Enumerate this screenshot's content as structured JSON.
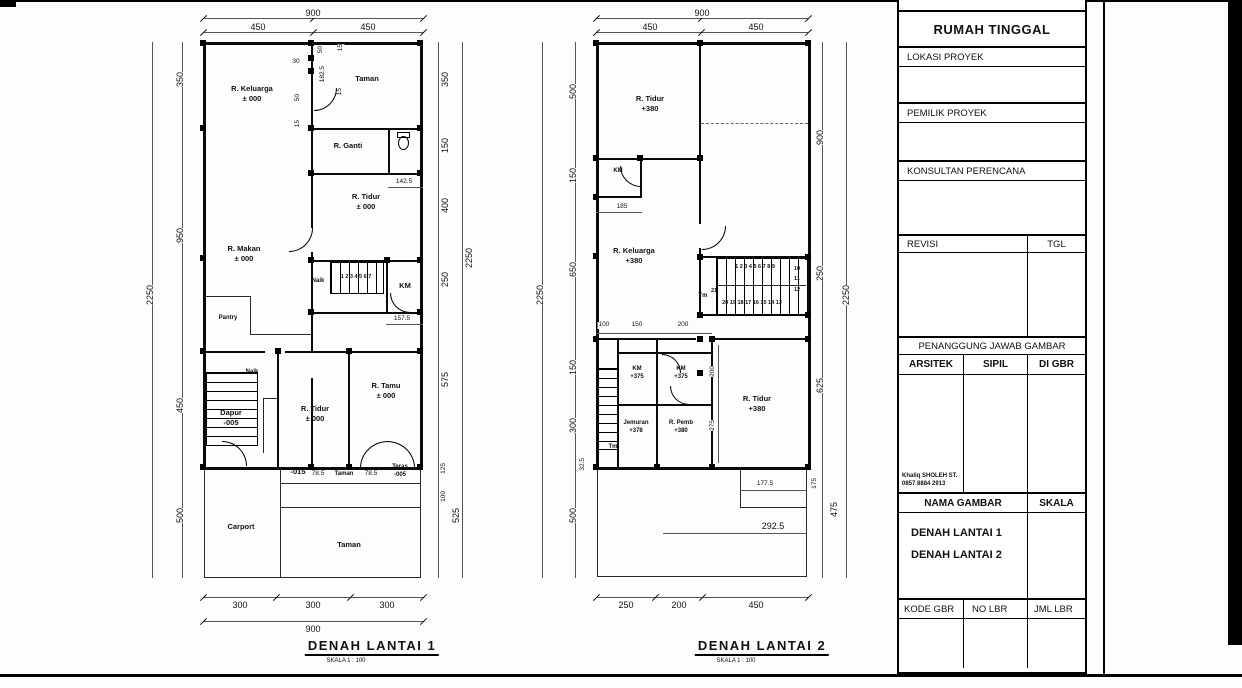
{
  "sheet": {
    "background": "#fdfdfd",
    "line_color": "#000000"
  },
  "title_block": {
    "nama_proyek_label": "NAMA PROYEK",
    "project_name": "RUMAH TINGGAL",
    "lokasi_label": "LOKASI PROYEK",
    "pemilik_label": "PEMILIK PROYEK",
    "konsultan_label": "KONSULTAN PERENCANA",
    "revisi_label": "REVISI",
    "tgl_label": "TGL",
    "penanggung_label": "PENANGGUNG JAWAB GAMBAR",
    "arsitek_label": "ARSITEK",
    "sipil_label": "SIPIL",
    "di_gbr_label": "DI GBR",
    "arsitek_name": "Khaliq SHOLEH ST.",
    "arsitek_phone": "0857 8884 2913",
    "nama_gambar_label": "NAMA GAMBAR",
    "skala_label": "SKALA",
    "drawing1": "DENAH LANTAI 1",
    "drawing2": "DENAH LANTAI 2",
    "kode_gbr_label": "KODE GBR",
    "no_lbr_label": "NO LBR",
    "jml_lbr_label": "JML LBR"
  },
  "plan1": {
    "title": "DENAH  LANTAI 1",
    "subtitle": "SKALA 1 : 100",
    "rooms": {
      "keluarga": "R. Keluarga\n± 000",
      "taman_atas": "Taman",
      "ganti": "R. Ganti",
      "tidur1": "R. Tidur\n± 000",
      "makan": "R. Makan\n± 000",
      "naik1": "Naik",
      "km1": "KM",
      "pantry": "Pantry",
      "naik2": "Naik",
      "dapur": "Dapur\n-005",
      "tidur2": "R. Tidur\n± 000",
      "tamu": "R. Tamu\n± 000",
      "taman_strip": "Taman",
      "teras": "Teras\n-005",
      "carport": "Carport",
      "taman_bawah": "Taman",
      "lvl015": "-015"
    },
    "stairs": {
      "numbers": "1 2 3 4 5 6 7"
    },
    "dims": {
      "top900": "900",
      "top450a": "450",
      "top450b": "450",
      "l2250": "2250",
      "l350": "350",
      "l950": "950",
      "l450": "450",
      "l500": "500",
      "r350": "350",
      "r150": "150",
      "r400": "400",
      "r250": "250",
      "r575": "575",
      "r125": "125",
      "r100": "100",
      "r525": "525",
      "r2250": "2250",
      "b300a": "300",
      "b300b": "300",
      "b300c": "300",
      "b900": "900",
      "d30": "30",
      "d50a": "50",
      "d15a": "15",
      "d1825": "182.5",
      "d15b": "15",
      "d50b": "50",
      "d15c": "15",
      "d1425": "142.5",
      "d1575": "157.5",
      "d785a": "78.5",
      "d785b": "78.5"
    }
  },
  "plan2": {
    "title": "DENAH  LANTAI 2",
    "subtitle": "SKALA 1 : 100",
    "rooms": {
      "tidur_atas": "R. Tidur\n+380",
      "km_atas": "KM",
      "keluarga": "R. Keluarga\n+380",
      "tm1": "Tm",
      "km1": "KM\n+375",
      "km2": "KM\n+375",
      "jemuran": "Jemuran\n+378",
      "pemb": "R. Pemb\n+380",
      "tidur_bawah": "R. Tidur\n+380",
      "tm2": "Tm"
    },
    "stairs": {
      "top_row": "1 2 3 4 5 6 7 8 9",
      "right_col": "10\n11\n12",
      "bottom_row": "20 19 18 17 16 15 14 13",
      "n21": "21"
    },
    "dims": {
      "top900": "900",
      "top450a": "450",
      "top450b": "450",
      "l500a": "500",
      "l150a": "150",
      "l650": "650",
      "l150b": "150",
      "l300": "300",
      "l325": "32.5",
      "l500b": "500",
      "l2250": "2250",
      "r900": "900",
      "r250": "250",
      "r625": "625",
      "r175": "175",
      "r475": "475",
      "r2250": "2250",
      "b250": "250",
      "b200": "200",
      "b450": "450",
      "d185": "185",
      "d100": "100",
      "d150": "150",
      "d200": "200",
      "d200v": "200",
      "d275": "275",
      "d1775": "177.5",
      "d2925": "292.5"
    }
  }
}
